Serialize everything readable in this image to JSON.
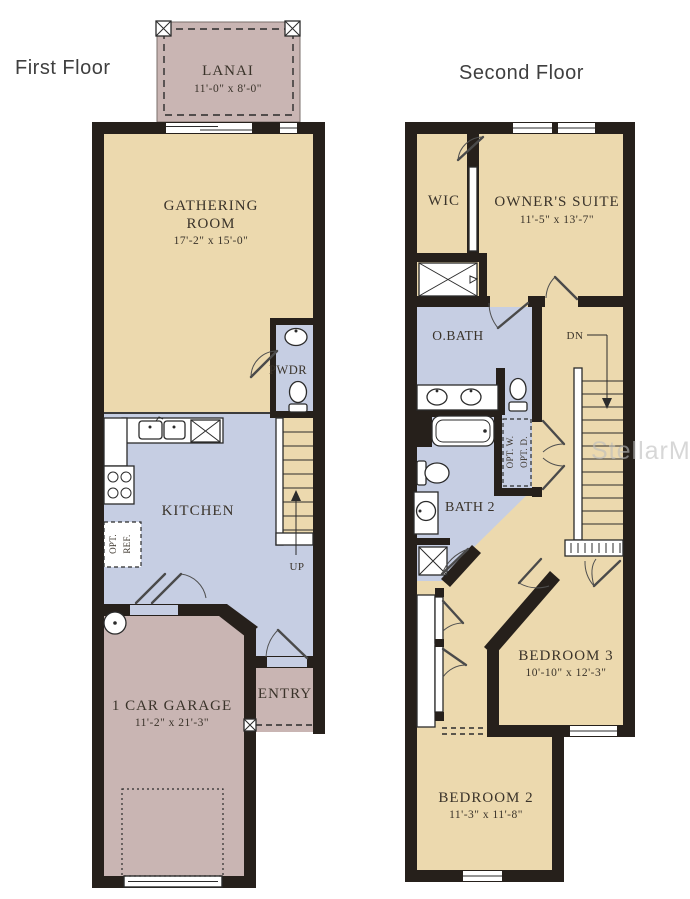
{
  "watermark": "StellarMLS",
  "palette": {
    "room_tan": "#ecd9ae",
    "room_mauve": "#c9b5b3",
    "room_blue": "#c6cee3",
    "wall_color": "#26201b",
    "title_text": "#3f3f3f",
    "label_text": "#3a332a"
  },
  "first_floor": {
    "title": "First Floor",
    "lanai": {
      "name": "LANAI",
      "dims": "11'-0\" x 8'-0\""
    },
    "gathering_room": {
      "name_line1": "GATHERING",
      "name_line2": "ROOM",
      "dims": "17'-2\" x 15'-0\""
    },
    "powder_room": {
      "name": "PWDR"
    },
    "kitchen": {
      "name": "KITCHEN"
    },
    "opt_ref": {
      "line1": "OPT.",
      "line2": "REF."
    },
    "stairs_label": "UP",
    "garage": {
      "name": "1 CAR GARAGE",
      "dims": "11'-2\" x 21'-3\""
    },
    "entry": {
      "name": "ENTRY"
    }
  },
  "second_floor": {
    "title": "Second Floor",
    "wic": {
      "name": "WIC"
    },
    "owners_suite": {
      "name": "OWNER'S SUITE",
      "dims": "11'-5\" x 13'-7\""
    },
    "owners_bath": {
      "name": "O.BATH"
    },
    "stairs_label": "DN",
    "opt_washer": "OPT. W.",
    "opt_dryer": "OPT. D.",
    "bath2": {
      "name": "BATH 2"
    },
    "bedroom3": {
      "name": "BEDROOM 3",
      "dims": "10'-10\" x 12'-3\""
    },
    "bedroom2": {
      "name": "BEDROOM 2",
      "dims": "11'-3\" x 11'-8\""
    }
  }
}
